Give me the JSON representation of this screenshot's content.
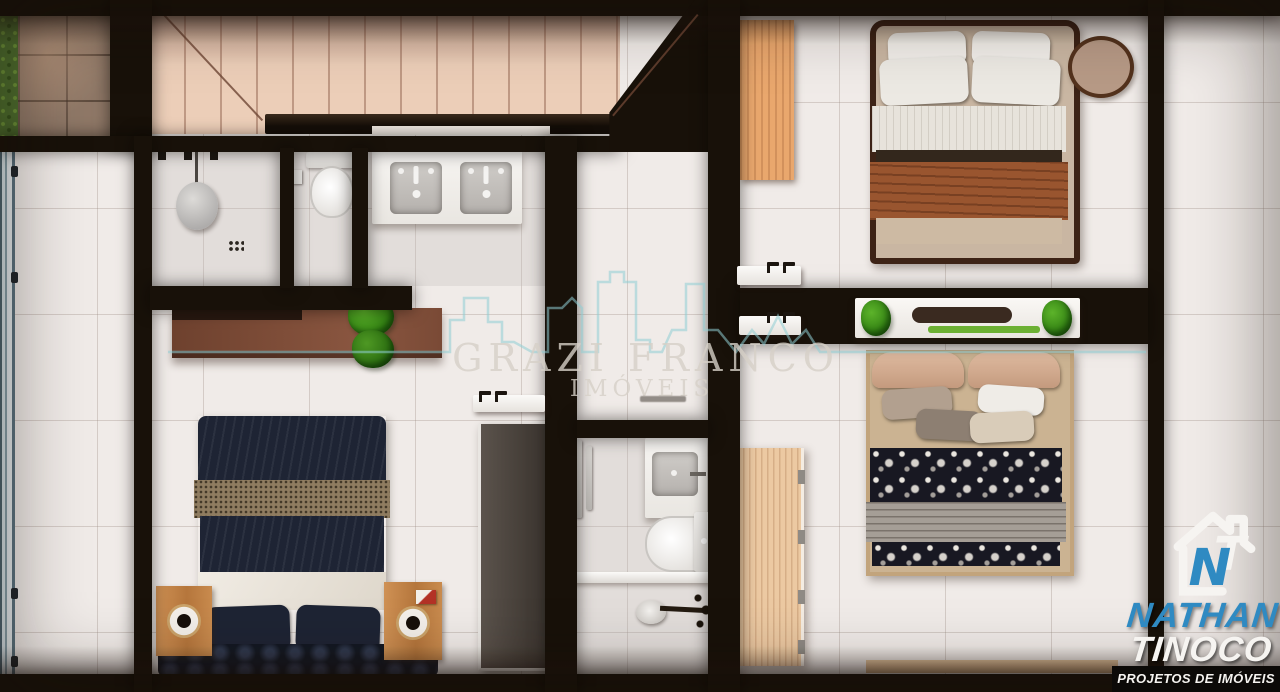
{
  "watermark": {
    "brand": "GRAZI FRANCO",
    "subtitle": "IMÓVEIS"
  },
  "logo": {
    "monogram_n": "N",
    "monogram_t": "T",
    "name_line1": "NATHAN",
    "name_line2": "TINOCO",
    "tagline": "PROJETOS DE IMÓVEIS 3D"
  },
  "palette": {
    "wall": "#181109",
    "floor": "#f0ebe8",
    "teal": "#8fced3",
    "logo_blue": "#2f8ac2",
    "navy": "#1e2434",
    "stairs_wood": "#ecceb8",
    "door_wood": "#e9a76d",
    "plant_green": "#3f9b1f"
  }
}
